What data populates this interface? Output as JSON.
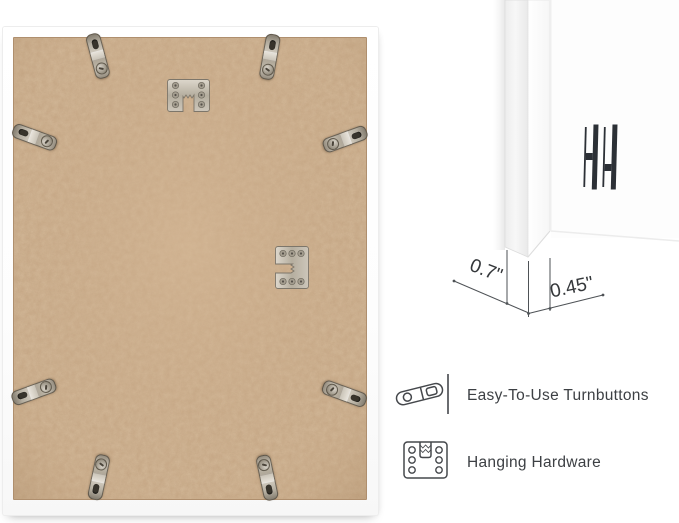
{
  "image": {
    "description": "Back view of a white picture frame with hardware callouts",
    "background": "#ffffff"
  },
  "back_view": {
    "frame_color": "#ffffff",
    "backing_color": "#c8a886",
    "turnbutton_count": 8,
    "hanger_count": 2,
    "hardware_names": [
      "sawtooth-hanger-vertical",
      "sawtooth-hanger-horizontal"
    ]
  },
  "corner_view": {
    "logo": "hh-monogram",
    "mat_color": "#fdfdfd"
  },
  "dimension_callout": {
    "depth": "0.7\"",
    "face_width": "0.45\""
  },
  "features": [
    {
      "icon": "turnbutton-icon",
      "label": "Easy-To-Use Turnbuttons"
    },
    {
      "icon": "hanging-hardware-icon",
      "label": "Hanging Hardware"
    }
  ],
  "colors": {
    "metal": "#b5ae9f",
    "text": "#3d4044",
    "line": "#4e5256",
    "logo": "#2c3036"
  }
}
